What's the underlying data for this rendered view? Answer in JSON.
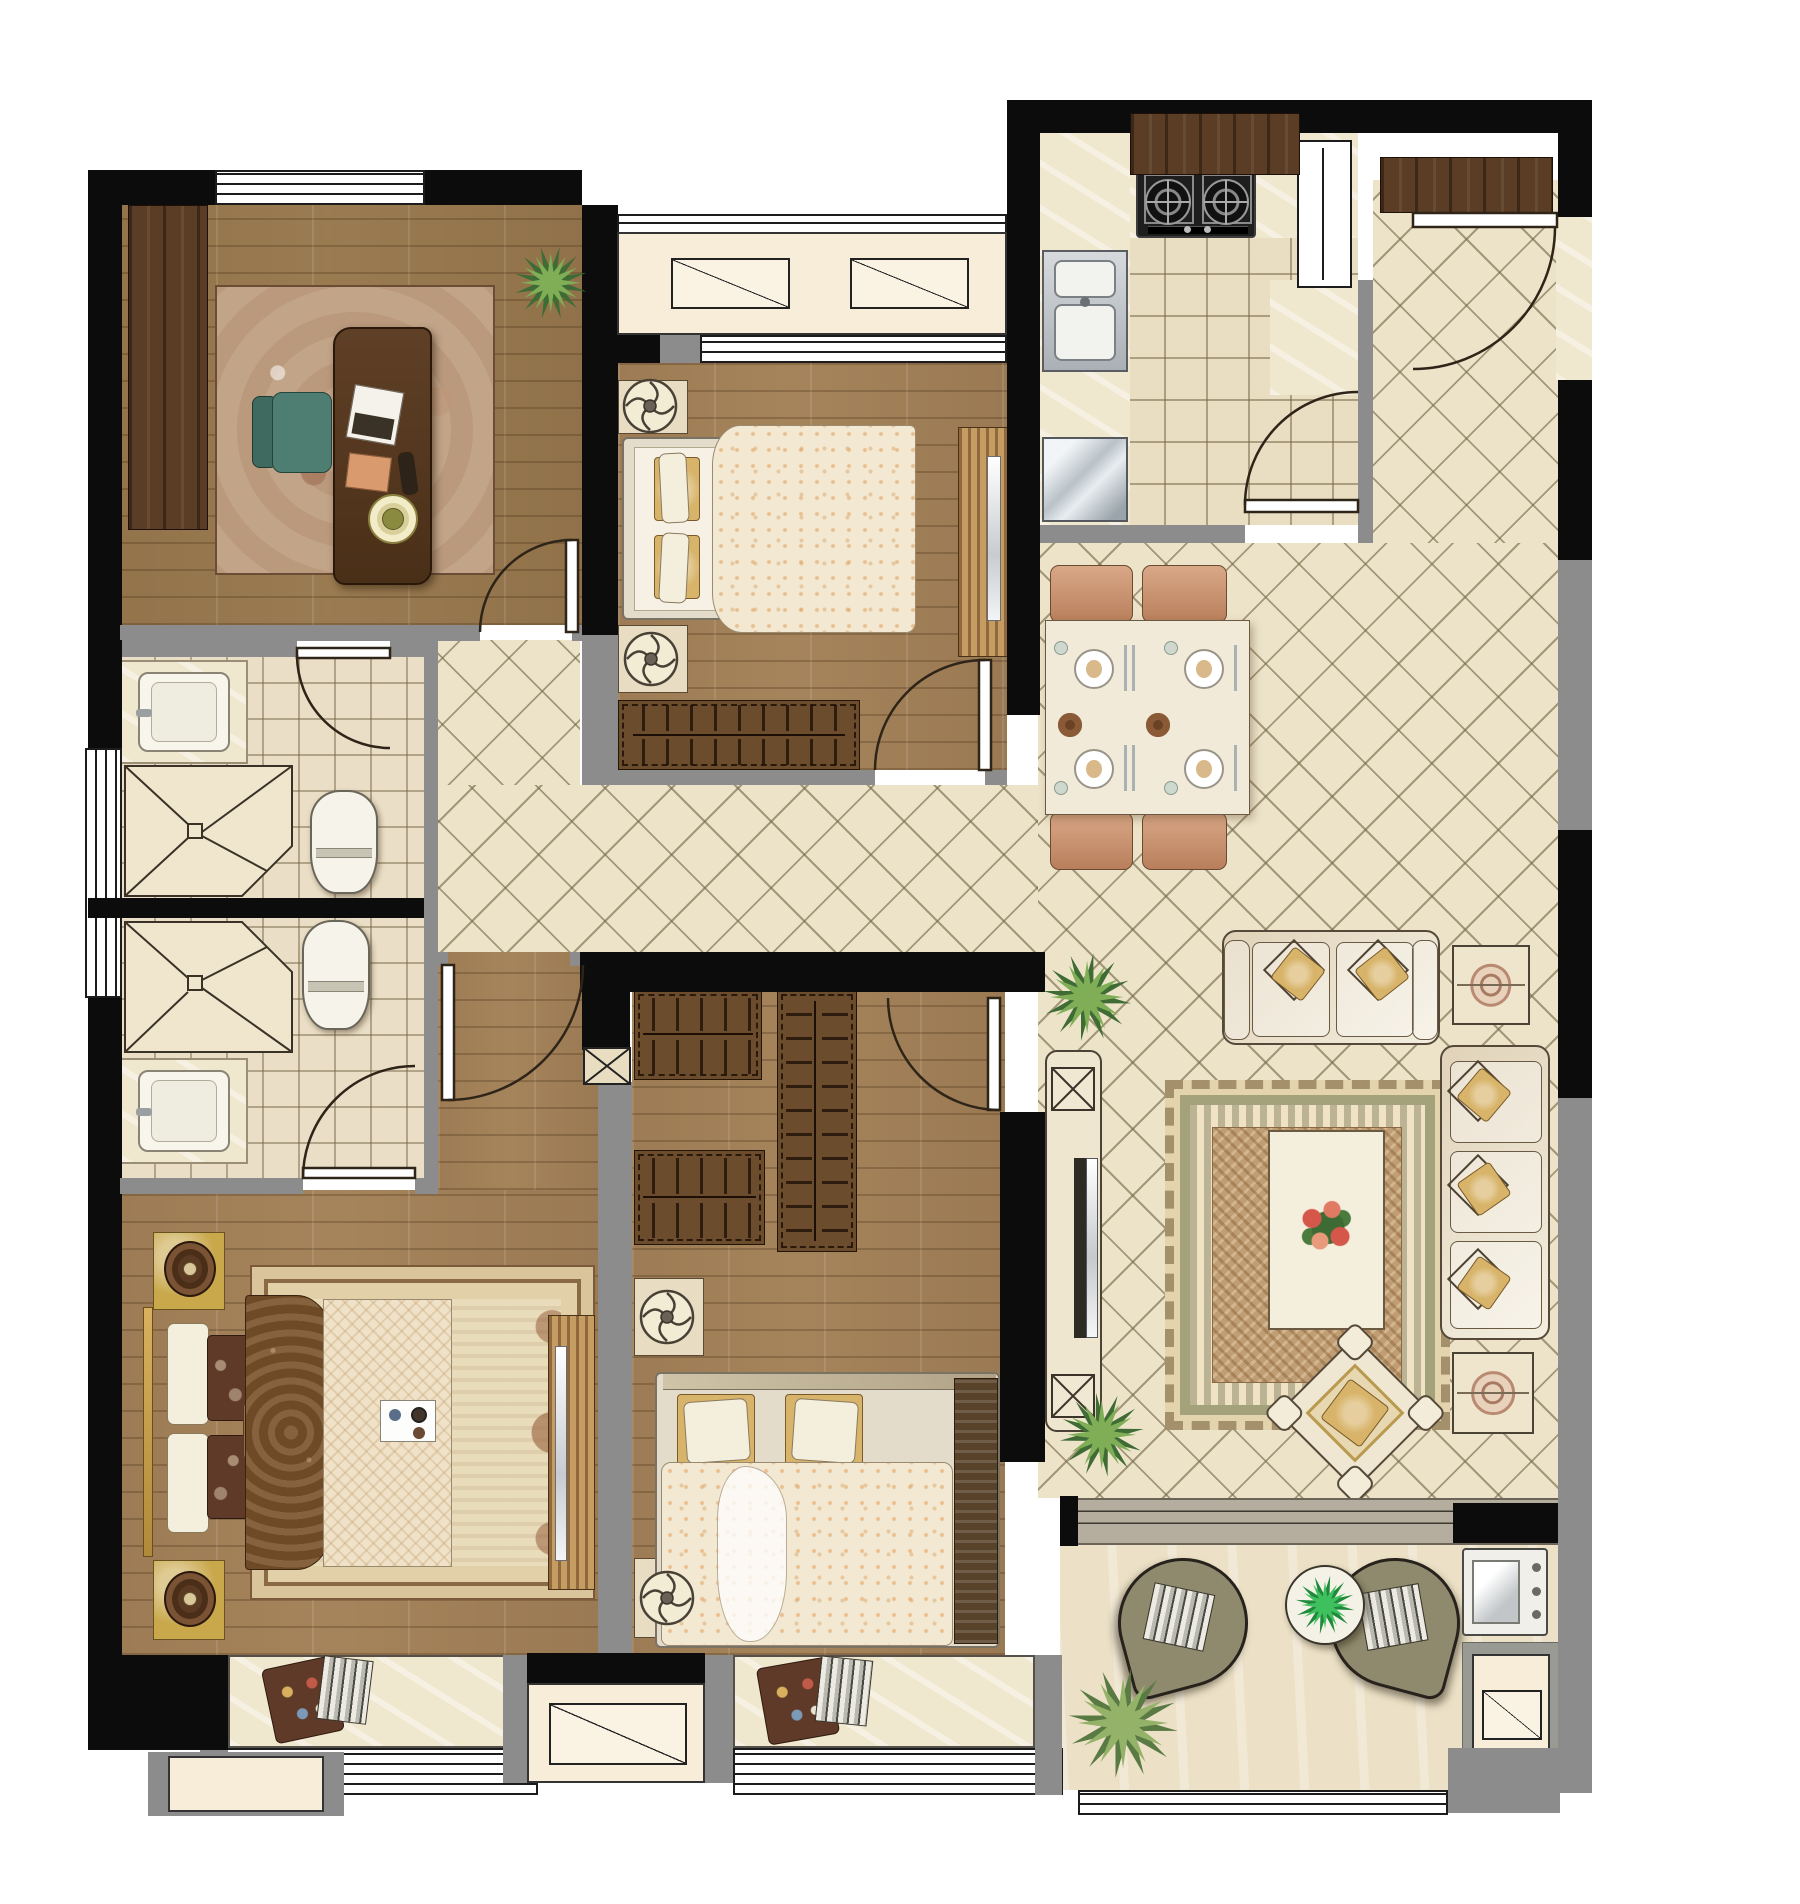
{
  "document": {
    "type": "architectural floor plan",
    "view": "top-down furnished interior render",
    "visible_text": [],
    "units_shown": false
  },
  "palette": {
    "background": "#ffffff",
    "wall_black": "#0c0c0c",
    "wall_gray": "#8c8c8c",
    "wood_floor": "#a5845c",
    "diamond_tile": "#ece3c9",
    "grid_tile": "#e9dec2",
    "marble_counter": "#f0e7cf",
    "dark_wood": "#5a3d24",
    "wardrobe_wood": "#6b4c2c",
    "duvet_cream": "#f3e8d2",
    "pillow_gold": "#d8b46a",
    "sofa_cream": "#efe7d2",
    "dining_chair": "#cf9d77",
    "teal_chair": "#4e7d72",
    "plant_green": "#7fae57",
    "balcony_chair": "#8f8a6d",
    "fixture_white": "#f6f3ea"
  },
  "rooms": [
    {
      "id": "study",
      "label": "study",
      "floor": "wood",
      "furniture": [
        "built-in wardrobe",
        "area rug",
        "writing desk",
        "laptop",
        "desk chair",
        "notepad",
        "record player",
        "potted plant",
        "swing door"
      ]
    },
    {
      "id": "bedroom-top",
      "label": "bedroom 2",
      "floor": "wood",
      "furniture": [
        "double bed",
        "2 nightstands with fan lamps",
        "wardrobe with hangers",
        "tv cabinet",
        "swing door",
        "north window",
        "ac ledge with 2 condenser units"
      ]
    },
    {
      "id": "kitchen",
      "label": "kitchen",
      "floor": "grid tile",
      "furniture": [
        "two-burner gas stove",
        "double stainless sink",
        "L counter",
        "refrigerator",
        "tall window",
        "swing door"
      ]
    },
    {
      "id": "foyer",
      "label": "entry foyer",
      "floor": "diamond tile",
      "furniture": [
        "entry swing door",
        "shoe cabinet",
        "hood cabinet",
        "marble jamb"
      ]
    },
    {
      "id": "dining",
      "label": "dining area",
      "floor": "diamond tile",
      "furniture": [
        "dining table",
        "4 chairs",
        "4 place settings",
        "2 serving bowls"
      ]
    },
    {
      "id": "living",
      "label": "living room",
      "floor": "diamond tile",
      "furniture": [
        "loveseat",
        "three-seat sofa",
        "2 corner side tables",
        "fringed area rug",
        "coffee table with flowers",
        "diamond armchair",
        "tv console",
        "2 speakers",
        "2 potted plants"
      ]
    },
    {
      "id": "bath-1",
      "label": "bathroom 1",
      "floor": "grid tile",
      "furniture": [
        "vanity sink",
        "corner shower",
        "toilet",
        "swing door",
        "frosted side window"
      ]
    },
    {
      "id": "bath-2",
      "label": "bathroom 2 (en-suite)",
      "floor": "grid tile",
      "furniture": [
        "vanity sink",
        "corner shower",
        "toilet",
        "swing door"
      ]
    },
    {
      "id": "master-suite",
      "label": "master bedroom with vestibule",
      "floor": "wood",
      "furniture": [
        "double bed",
        "ornate rug",
        "2 gold nightstands with record discs",
        "tv dresser",
        "vestibule swing door",
        "bay window with cushions"
      ]
    },
    {
      "id": "bedroom-3",
      "label": "bedroom 3",
      "floor": "wood",
      "furniture": [
        "double bed",
        "3 wardrobe sections with hangers",
        "2 nightstands with fan lamps",
        "structural column",
        "swing door",
        "bay window with cushions"
      ]
    },
    {
      "id": "balcony",
      "label": "balcony",
      "floor": "stone",
      "furniture": [
        "2 teardrop lounge chairs",
        "round plant table",
        "2 potted plants",
        "washing machine",
        "sliding door band",
        "ac platform"
      ]
    }
  ],
  "openings": {
    "swing_doors": 9,
    "windows": [
      "study top",
      "bedroom-2 top",
      "kitchen tall",
      "bathroom side frosted",
      "master bay",
      "bedroom-3 bay",
      "balcony rail"
    ],
    "ac_platforms": 3
  }
}
